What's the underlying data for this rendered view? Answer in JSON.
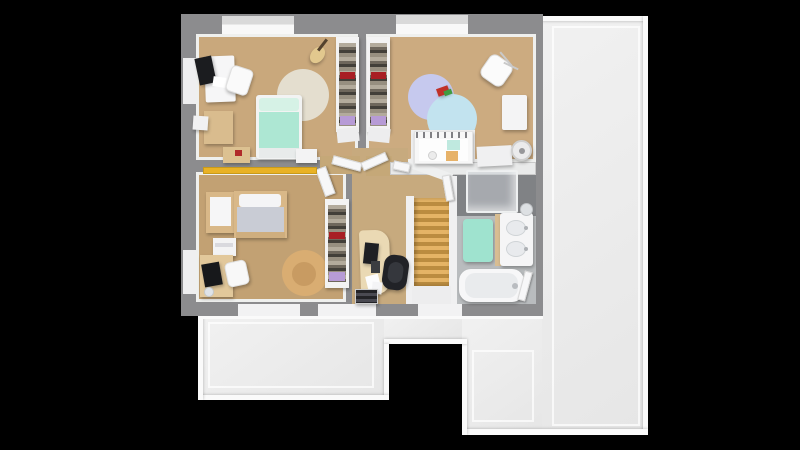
{
  "scene": {
    "width": 800,
    "height": 450,
    "background": "#000000",
    "kind": "3d-floor-plan-top-view"
  },
  "palette": {
    "roof": "#ececec",
    "roof_edge": "#fafafa",
    "wall": "#8c8c8e",
    "wall_face_white": "#f0f0f1",
    "wood_room1": "#c9a87c",
    "wood_room2": "#ccab80",
    "wood_master": "#c2a173",
    "wood_hall": "#c7aa7e",
    "bath_floor": "#b9bcbe",
    "shower_floor": "#808285",
    "stair_wood": "#d0a053",
    "teen_bed_mint": "#ade7d3",
    "master_duvet_gray": "#c9ccd5",
    "bed_frame_wood": "#d9b888",
    "rug_beige": "#e4decf",
    "rug_lavender": "#c6c9ee",
    "rug_blue": "#c2e3ef",
    "rug_tan": "#d9ad72",
    "shelf_yellow": "#e9b225",
    "bath_mat_mint": "#9fe3cf",
    "accent_red": "#a81e24",
    "accent_purple": "#b79bd6",
    "chair_black": "#212227"
  },
  "shapes": [
    {
      "n": "roof-right-section",
      "x": 540,
      "y": 16,
      "w": 108,
      "h": 419,
      "cls": "roof"
    },
    {
      "n": "roof-bottom-left-section",
      "x": 198,
      "y": 314,
      "w": 186,
      "h": 86,
      "cls": "roof"
    },
    {
      "n": "roof-bottom-mid-section",
      "x": 384,
      "y": 314,
      "w": 82,
      "h": 30,
      "cls": "roof"
    },
    {
      "n": "roof-bottom-right-section",
      "x": 462,
      "y": 314,
      "w": 80,
      "h": 121,
      "cls": "roof"
    },
    {
      "n": "roof-ridge-top",
      "x": 540,
      "y": 16,
      "w": 108,
      "h": 5,
      "cls": "ridge"
    },
    {
      "n": "roof-ridge-right",
      "x": 643,
      "y": 16,
      "w": 5,
      "h": 419,
      "cls": "ridge"
    },
    {
      "n": "roof-ridge-bottom-right",
      "x": 462,
      "y": 429,
      "w": 186,
      "h": 6,
      "cls": "ridge"
    },
    {
      "n": "roof-ridge-notch-right",
      "x": 462,
      "y": 344,
      "w": 5,
      "h": 91,
      "cls": "ridge"
    },
    {
      "n": "roof-ridge-notch-top",
      "x": 384,
      "y": 339,
      "w": 83,
      "h": 5,
      "cls": "ridge"
    },
    {
      "n": "roof-ridge-notch-left",
      "x": 384,
      "y": 344,
      "w": 5,
      "h": 56,
      "cls": "ridge"
    },
    {
      "n": "roof-ridge-bottom-left",
      "x": 198,
      "y": 395,
      "w": 191,
      "h": 5,
      "cls": "ridge"
    },
    {
      "n": "roof-ridge-left",
      "x": 198,
      "y": 314,
      "w": 5,
      "h": 86,
      "cls": "ridge"
    },
    {
      "n": "roof-inset-line-right",
      "x": 552,
      "y": 26,
      "w": 88,
      "h": 400,
      "bg": "none",
      "bd": "2px solid rgba(255,255,255,0.7)"
    },
    {
      "n": "roof-inset-line-bottom-left",
      "x": 208,
      "y": 322,
      "w": 166,
      "h": 66,
      "bg": "none",
      "bd": "2px solid rgba(255,255,255,0.7)"
    },
    {
      "n": "roof-inset-line-bottom-right",
      "x": 472,
      "y": 350,
      "w": 62,
      "h": 72,
      "bg": "none",
      "bd": "2px solid rgba(255,255,255,0.7)"
    },
    {
      "n": "building-wall-mass",
      "x": 181,
      "y": 14,
      "w": 362,
      "h": 302,
      "bg": "#8c8c8e"
    },
    {
      "n": "roof-ridge-under-wall",
      "x": 198,
      "y": 316,
      "w": 345,
      "h": 3,
      "bg": "#fafafa"
    },
    {
      "n": "dormer-window-1",
      "x": 222,
      "y": 16,
      "w": 72,
      "h": 21,
      "cls": "sill"
    },
    {
      "n": "dormer-window-2",
      "x": 396,
      "y": 15,
      "w": 72,
      "h": 22,
      "cls": "sill"
    },
    {
      "n": "window-sill-left-1",
      "x": 183,
      "y": 58,
      "w": 13,
      "h": 46,
      "bg": "#efeff0"
    },
    {
      "n": "window-sill-left-2",
      "x": 183,
      "y": 250,
      "w": 13,
      "h": 44,
      "bg": "#efeff0"
    },
    {
      "n": "window-sill-bottom-1",
      "x": 238,
      "y": 304,
      "w": 62,
      "h": 12,
      "bg": "#f2f2f3"
    },
    {
      "n": "window-sill-bottom-2",
      "x": 318,
      "y": 304,
      "w": 58,
      "h": 12,
      "bg": "#f2f2f3"
    },
    {
      "n": "window-sill-bottom-3",
      "x": 418,
      "y": 304,
      "w": 44,
      "h": 12,
      "bg": "#f2f2f3"
    },
    {
      "n": "floor-bedroom-teen",
      "x": 196,
      "y": 34,
      "w": 162,
      "h": 126,
      "bg": "#c9a87c",
      "cls": "wood",
      "bd": "3px solid #eff0ee"
    },
    {
      "n": "floor-bedroom-nursery",
      "x": 366,
      "y": 34,
      "w": 170,
      "h": 128,
      "bg": "#ccab80",
      "cls": "wood",
      "bd": "3px solid #eff0ee"
    },
    {
      "n": "floor-bedroom-master",
      "x": 196,
      "y": 172,
      "w": 150,
      "h": 130,
      "bg": "#c2a173",
      "cls": "wood",
      "bd": "3px solid #eff0ee"
    },
    {
      "n": "floor-hallway",
      "x": 352,
      "y": 148,
      "w": 56,
      "h": 156,
      "bg": "#c7aa7e",
      "cls": "wood"
    },
    {
      "n": "floor-hallway-arm",
      "x": 408,
      "y": 174,
      "w": 44,
      "h": 24,
      "bg": "#c7aa7e",
      "cls": "wood"
    },
    {
      "n": "doorway-patch-master-teen",
      "x": 320,
      "y": 156,
      "w": 40,
      "h": 18,
      "bg": "#c5a878",
      "cls": "wood"
    },
    {
      "n": "doorway-patch-nursery",
      "x": 366,
      "y": 156,
      "w": 26,
      "h": 20,
      "bg": "#c5a878",
      "cls": "wood"
    },
    {
      "n": "floor-shower-zone",
      "x": 455,
      "y": 174,
      "w": 81,
      "h": 42,
      "bg": "#808285"
    },
    {
      "n": "floor-bathroom",
      "x": 455,
      "y": 216,
      "w": 81,
      "h": 88,
      "bg": "#b9bcbe",
      "cls": "tiles"
    },
    {
      "n": "wall-nursery-south",
      "x": 390,
      "y": 162,
      "w": 146,
      "h": 13,
      "bg": "#e9eaea",
      "bd": "1px solid #c9c9c9"
    },
    {
      "n": "wall-stairwell-left",
      "x": 406,
      "y": 196,
      "w": 8,
      "h": 108,
      "bg": "#f0f0f1"
    },
    {
      "n": "wall-bath-divider",
      "x": 449,
      "y": 176,
      "w": 8,
      "h": 128,
      "bg": "#f0f0f1"
    },
    {
      "n": "wall-stair-header",
      "x": 407,
      "y": 166,
      "w": 46,
      "h": 9,
      "bg": "#eff0f0",
      "rot": 20
    },
    {
      "n": "staircase-treads",
      "x": 414,
      "y": 198,
      "w": 35,
      "h": 88,
      "cls": "stairs"
    },
    {
      "n": "staircase-landing",
      "x": 412,
      "y": 286,
      "w": 39,
      "h": 18,
      "bg": "#ededee"
    },
    {
      "n": "shower-glass-enclosure",
      "x": 466,
      "y": 170,
      "w": 52,
      "h": 43,
      "cls": "glass",
      "r": 2
    },
    {
      "n": "bath-mat",
      "x": 463,
      "y": 219,
      "w": 30,
      "h": 43,
      "bg": "#9fe3cf",
      "r": 4,
      "sh": true
    },
    {
      "n": "vanity-wood-side",
      "x": 495,
      "y": 214,
      "w": 6,
      "h": 52,
      "bg": "#d8bd92"
    },
    {
      "n": "vanity-double-sink",
      "x": 500,
      "y": 213,
      "w": 33,
      "h": 53,
      "bg": "#f5f5f6",
      "r": 3,
      "sh": true
    },
    {
      "n": "sink-basin-1",
      "x": 506,
      "y": 220,
      "w": 20,
      "h": 16,
      "bg": "#e8eaed",
      "r": "50%",
      "bd": "1px solid #cfd3d6"
    },
    {
      "n": "sink-basin-2",
      "x": 506,
      "y": 241,
      "w": 20,
      "h": 16,
      "bg": "#e8eaed",
      "r": "50%",
      "bd": "1px solid #cfd3d6"
    },
    {
      "n": "sink-faucet-1",
      "x": 524,
      "y": 226,
      "w": 4,
      "h": 4,
      "bg": "#aeb1b5",
      "r": "50%"
    },
    {
      "n": "sink-faucet-2",
      "x": 524,
      "y": 247,
      "w": 4,
      "h": 4,
      "bg": "#aeb1b5",
      "r": "50%"
    },
    {
      "n": "vanity-round-mirror",
      "x": 520,
      "y": 203,
      "w": 13,
      "h": 13,
      "bg": "#dde0e3",
      "r": "50%",
      "bd": "1px solid #bfc2c5"
    },
    {
      "n": "bathtub",
      "x": 459,
      "y": 269,
      "w": 65,
      "h": 33,
      "bg": "#f7f7f8",
      "r": 12,
      "sh": true
    },
    {
      "n": "bathtub-inner",
      "x": 465,
      "y": 273,
      "w": 53,
      "h": 25,
      "bg": "#e9ebed",
      "r": 10
    },
    {
      "n": "bathtub-faucet",
      "x": 512,
      "y": 283,
      "w": 6,
      "h": 6,
      "bg": "#b9bcc0",
      "r": "50%"
    },
    {
      "n": "door-bathroom",
      "x": 521,
      "y": 271,
      "w": 8,
      "h": 30,
      "cls": "door",
      "rot": 15
    },
    {
      "n": "door-master-bedroom",
      "x": 320,
      "y": 167,
      "w": 11,
      "h": 29,
      "cls": "door",
      "rot": -20
    },
    {
      "n": "door-teen-bedroom",
      "x": 332,
      "y": 159,
      "w": 30,
      "h": 9,
      "cls": "door",
      "rot": 15
    },
    {
      "n": "door-nursery",
      "x": 361,
      "y": 157,
      "w": 27,
      "h": 9,
      "cls": "door",
      "rot": -24
    },
    {
      "n": "door-nursery-small",
      "x": 393,
      "y": 162,
      "w": 17,
      "h": 9,
      "cls": "door",
      "rot": 12
    },
    {
      "n": "door-bathroom-entry",
      "x": 444,
      "y": 175,
      "w": 8,
      "h": 26,
      "cls": "door",
      "rot": -10
    },
    {
      "n": "teen-desk",
      "x": 205,
      "y": 56,
      "w": 30,
      "h": 46,
      "bg": "#f6f6f7",
      "r": 2,
      "rot": -2,
      "sh": true
    },
    {
      "n": "teen-desk-monitor",
      "x": 197,
      "y": 57,
      "w": 17,
      "h": 27,
      "bg": "#1b1c1f",
      "rot": -12,
      "sh": true
    },
    {
      "n": "teen-desk-papers",
      "x": 213,
      "y": 77,
      "w": 13,
      "h": 10,
      "bg": "#ffffff",
      "rot": 8
    },
    {
      "n": "teen-desk-chair",
      "x": 228,
      "y": 67,
      "w": 23,
      "h": 27,
      "bg": "#fafafa",
      "r": 5,
      "rot": 18,
      "bd": "1px solid #e0e0e0",
      "sh": true
    },
    {
      "n": "teen-cube-shelf",
      "x": 204,
      "y": 111,
      "w": 29,
      "h": 33,
      "bg": "#d9bc8e",
      "cls": "cubbies",
      "sh": true
    },
    {
      "n": "teen-wall-speaker",
      "x": 193,
      "y": 116,
      "w": 15,
      "h": 14,
      "bg": "#f1f1f2",
      "rot": 4,
      "sh": true
    },
    {
      "n": "teen-round-rug",
      "x": 277,
      "y": 69,
      "w": 52,
      "h": 52,
      "bg": "#e4decf",
      "r": "50%"
    },
    {
      "n": "teen-bed-base",
      "x": 256,
      "y": 95,
      "w": 46,
      "h": 64,
      "bg": "#f2f3f3",
      "r": 3,
      "sh": true
    },
    {
      "n": "teen-bed-pillow",
      "x": 259,
      "y": 98,
      "w": 40,
      "h": 13,
      "bg": "#d6f2e6",
      "r": 3
    },
    {
      "n": "teen-bed-duvet",
      "x": 259,
      "y": 112,
      "w": 40,
      "h": 36,
      "bg": "#ade7d3"
    },
    {
      "n": "teen-bed-footboard",
      "x": 259,
      "y": 148,
      "w": 40,
      "h": 10,
      "bg": "#e8ebeb"
    },
    {
      "n": "teen-nightstand",
      "x": 223,
      "y": 147,
      "w": 27,
      "h": 16,
      "bg": "#dcc191",
      "sh": true
    },
    {
      "n": "teen-nightstand-item",
      "x": 235,
      "y": 150,
      "w": 7,
      "h": 6,
      "bg": "#b02a2a"
    },
    {
      "n": "teen-side-table",
      "x": 296,
      "y": 149,
      "w": 21,
      "h": 14,
      "bg": "#f3f3f4",
      "sh": true
    },
    {
      "n": "teen-wardrobe-frame",
      "x": 336,
      "y": 37,
      "w": 23,
      "h": 95,
      "bg": "#f3f3f3",
      "sh": true
    },
    {
      "n": "teen-wardrobe-clothes",
      "x": 339,
      "y": 43,
      "w": 17,
      "h": 83,
      "cls": "clothes"
    },
    {
      "n": "teen-wardrobe-red-cloth",
      "x": 340,
      "y": 72,
      "w": 15,
      "h": 7,
      "bg": "#a81e24"
    },
    {
      "n": "teen-wardrobe-boxes",
      "x": 340,
      "y": 116,
      "w": 15,
      "h": 9,
      "bg": "#b79bd6"
    },
    {
      "n": "guitar-body",
      "x": 311,
      "y": 46,
      "w": 13,
      "h": 18,
      "bg": "#e2c88e",
      "r": "50%",
      "rot": 38,
      "sh": true
    },
    {
      "n": "guitar-neck",
      "x": 321,
      "y": 38,
      "w": 3,
      "h": 14,
      "bg": "#54422e",
      "rot": 38
    },
    {
      "n": "nursery-wardrobe-frame",
      "x": 367,
      "y": 37,
      "w": 23,
      "h": 95,
      "bg": "#f3f3f3",
      "sh": true
    },
    {
      "n": "nursery-wardrobe-clothes",
      "x": 370,
      "y": 43,
      "w": 17,
      "h": 83,
      "cls": "clothes"
    },
    {
      "n": "nursery-wardrobe-red-cloth",
      "x": 371,
      "y": 72,
      "w": 15,
      "h": 7,
      "bg": "#a81e24"
    },
    {
      "n": "nursery-wardrobe-boxes",
      "x": 371,
      "y": 116,
      "w": 15,
      "h": 9,
      "bg": "#b79bd6"
    },
    {
      "n": "wardrobe-base-left",
      "x": 337,
      "y": 128,
      "w": 22,
      "h": 14,
      "bg": "#ededee",
      "rot": -6
    },
    {
      "n": "wardrobe-base-right",
      "x": 368,
      "y": 128,
      "w": 22,
      "h": 14,
      "bg": "#ededee",
      "rot": 6
    },
    {
      "n": "nursery-rug-lavender",
      "x": 408,
      "y": 74,
      "w": 46,
      "h": 46,
      "bg": "#c6c9ee",
      "r": "50%"
    },
    {
      "n": "nursery-rug-blue",
      "x": 427,
      "y": 94,
      "w": 50,
      "h": 50,
      "bg": "#c2e3ef",
      "r": "50%"
    },
    {
      "n": "nursery-rocking-toy-body",
      "x": 437,
      "y": 87,
      "w": 12,
      "h": 8,
      "bg": "#c03028",
      "rot": -20,
      "sh": true
    },
    {
      "n": "nursery-rocking-toy-seat",
      "x": 444,
      "y": 90,
      "w": 8,
      "h": 5,
      "bg": "#3f9b40",
      "rot": -20
    },
    {
      "n": "nursery-hanging-chair",
      "x": 483,
      "y": 57,
      "w": 27,
      "h": 27,
      "bg": "#fbfbfb",
      "r": 7,
      "rot": 35,
      "bd": "1px solid #dddddd",
      "sh": true
    },
    {
      "n": "hanging-chair-frame-1",
      "x": 505,
      "y": 50,
      "w": 2,
      "h": 18,
      "bg": "#c9c9c9",
      "rot": -40
    },
    {
      "n": "hanging-chair-frame-2",
      "x": 510,
      "y": 58,
      "w": 2,
      "h": 16,
      "bg": "#c9c9c9",
      "rot": -65
    },
    {
      "n": "nursery-wall-cabinet",
      "x": 502,
      "y": 95,
      "w": 25,
      "h": 35,
      "bg": "#f4f4f5",
      "r": 2,
      "sh": true
    },
    {
      "n": "crib-mat",
      "x": 411,
      "y": 130,
      "w": 64,
      "h": 32,
      "bg": "#efefef"
    },
    {
      "n": "crib-frame",
      "x": 414,
      "y": 131,
      "w": 59,
      "h": 33,
      "bg": "#f7f7f7",
      "bd": "1px solid #e3e3e3",
      "sh": true
    },
    {
      "n": "crib-slat-rail",
      "x": 416,
      "y": 132,
      "w": 55,
      "h": 6,
      "cls": "slats"
    },
    {
      "n": "crib-interior",
      "x": 419,
      "y": 139,
      "w": 49,
      "h": 22,
      "bg": "#fdfdfd"
    },
    {
      "n": "crib-mint-blanket",
      "x": 447,
      "y": 140,
      "w": 13,
      "h": 10,
      "bg": "#bfe9df"
    },
    {
      "n": "crib-orange-cushion",
      "x": 446,
      "y": 151,
      "w": 12,
      "h": 10,
      "bg": "#e7b269"
    },
    {
      "n": "crib-round-toy",
      "x": 428,
      "y": 151,
      "w": 9,
      "h": 9,
      "bg": "#ececec",
      "r": "50%",
      "bd": "1px solid #d0d0d0"
    },
    {
      "n": "nursery-white-chest",
      "x": 477,
      "y": 146,
      "w": 35,
      "h": 20,
      "bg": "#f0f0f1",
      "rot": -3,
      "sh": true
    },
    {
      "n": "nursery-fan",
      "x": 511,
      "y": 140,
      "w": 21,
      "h": 21,
      "bg": "#ebebec",
      "r": "50%",
      "bd": "2px solid #cfcfcf",
      "sh": true
    },
    {
      "n": "nursery-fan-hub",
      "x": 519,
      "y": 148,
      "w": 6,
      "h": 6,
      "bg": "#97979a",
      "r": "50%"
    },
    {
      "n": "master-yellow-shelf",
      "x": 203,
      "y": 167,
      "w": 114,
      "h": 7,
      "bg": "#e9b225",
      "bd": "1px solid #c89a1a"
    },
    {
      "n": "master-bench-frame",
      "x": 206,
      "y": 192,
      "w": 30,
      "h": 41,
      "bg": "#d9b888",
      "sh": true
    },
    {
      "n": "master-bench-cushion",
      "x": 210,
      "y": 197,
      "w": 21,
      "h": 29,
      "bg": "#f6f6f7"
    },
    {
      "n": "master-bed-frame",
      "x": 234,
      "y": 191,
      "w": 53,
      "h": 47,
      "bg": "#d9b888",
      "sh": true
    },
    {
      "n": "master-bed-pillow",
      "x": 239,
      "y": 194,
      "w": 42,
      "h": 13,
      "bg": "#f4f4f6",
      "r": 3
    },
    {
      "n": "master-bed-duvet",
      "x": 237,
      "y": 207,
      "w": 47,
      "h": 26,
      "bg": "#c9ccd5"
    },
    {
      "n": "master-bed-footboard",
      "x": 236,
      "y": 232,
      "w": 49,
      "h": 6,
      "bg": "#cfae7e"
    },
    {
      "n": "master-nightstand",
      "x": 213,
      "y": 238,
      "w": 23,
      "h": 18,
      "bg": "#f3f3f4",
      "sh": true
    },
    {
      "n": "master-nightstand-drawer",
      "x": 215,
      "y": 243,
      "w": 18,
      "h": 4,
      "bg": "#d9d9de"
    },
    {
      "n": "master-desk",
      "x": 200,
      "y": 255,
      "w": 33,
      "h": 42,
      "bg": "#e2c89b",
      "sh": true
    },
    {
      "n": "master-desk-monitor",
      "x": 203,
      "y": 263,
      "w": 18,
      "h": 23,
      "bg": "#17181b",
      "rot": -10,
      "sh": true
    },
    {
      "n": "master-desk-chair",
      "x": 226,
      "y": 261,
      "w": 22,
      "h": 25,
      "bg": "#f8f8f8",
      "r": 5,
      "rot": -12,
      "bd": "1px solid #e2e2e2",
      "sh": true
    },
    {
      "n": "master-desk-globe",
      "x": 204,
      "y": 287,
      "w": 10,
      "h": 10,
      "bg": "#dfe3e8",
      "r": "50%",
      "bd": "1px solid #c4c8cc"
    },
    {
      "n": "master-round-rug",
      "x": 282,
      "y": 250,
      "w": 46,
      "h": 46,
      "bg": "#d9ad72",
      "r": "50%"
    },
    {
      "n": "master-rug-shading",
      "x": 292,
      "y": 262,
      "w": 24,
      "h": 24,
      "bg": "rgba(120,80,30,0.18)",
      "r": "50%"
    },
    {
      "n": "master-wardrobe-frame",
      "x": 325,
      "y": 199,
      "w": 24,
      "h": 89,
      "bg": "#f3f3f3",
      "sh": true
    },
    {
      "n": "master-wardrobe-clothes",
      "x": 328,
      "y": 205,
      "w": 18,
      "h": 77,
      "cls": "clothes"
    },
    {
      "n": "master-wardrobe-red-cloth",
      "x": 329,
      "y": 232,
      "w": 16,
      "h": 7,
      "bg": "#a81e24"
    },
    {
      "n": "master-wardrobe-boxes",
      "x": 329,
      "y": 272,
      "w": 16,
      "h": 9,
      "bg": "#b79bd6"
    },
    {
      "n": "office-curved-desk",
      "x": 360,
      "y": 230,
      "w": 30,
      "h": 64,
      "bg": "#ead9b4",
      "r": "4px 14px 14px 4px",
      "rot": -2,
      "sh": true
    },
    {
      "n": "office-monitor",
      "x": 364,
      "y": 243,
      "w": 14,
      "h": 21,
      "bg": "#1e1f23",
      "rot": 6,
      "sh": true
    },
    {
      "n": "office-keyboard",
      "x": 371,
      "y": 261,
      "w": 9,
      "h": 12,
      "bg": "#3b3d41"
    },
    {
      "n": "office-chair",
      "x": 383,
      "y": 255,
      "w": 25,
      "h": 35,
      "bg": "#212227",
      "r": 10,
      "rot": 8,
      "sh": true
    },
    {
      "n": "office-chair-pad",
      "x": 388,
      "y": 262,
      "w": 15,
      "h": 21,
      "bg": "#35373d",
      "r": 8,
      "rot": 8
    },
    {
      "n": "office-papers-1",
      "x": 367,
      "y": 275,
      "w": 13,
      "h": 17,
      "bg": "#fcfcfd",
      "rot": -14
    },
    {
      "n": "office-papers-2",
      "x": 372,
      "y": 282,
      "w": 10,
      "h": 12,
      "bg": "#f4f4f6",
      "rot": 6
    },
    {
      "n": "office-low-shelf",
      "x": 355,
      "y": 289,
      "w": 23,
      "h": 15,
      "cls": "books",
      "bd": "1px solid #cfcfcf",
      "sh": true
    }
  ]
}
